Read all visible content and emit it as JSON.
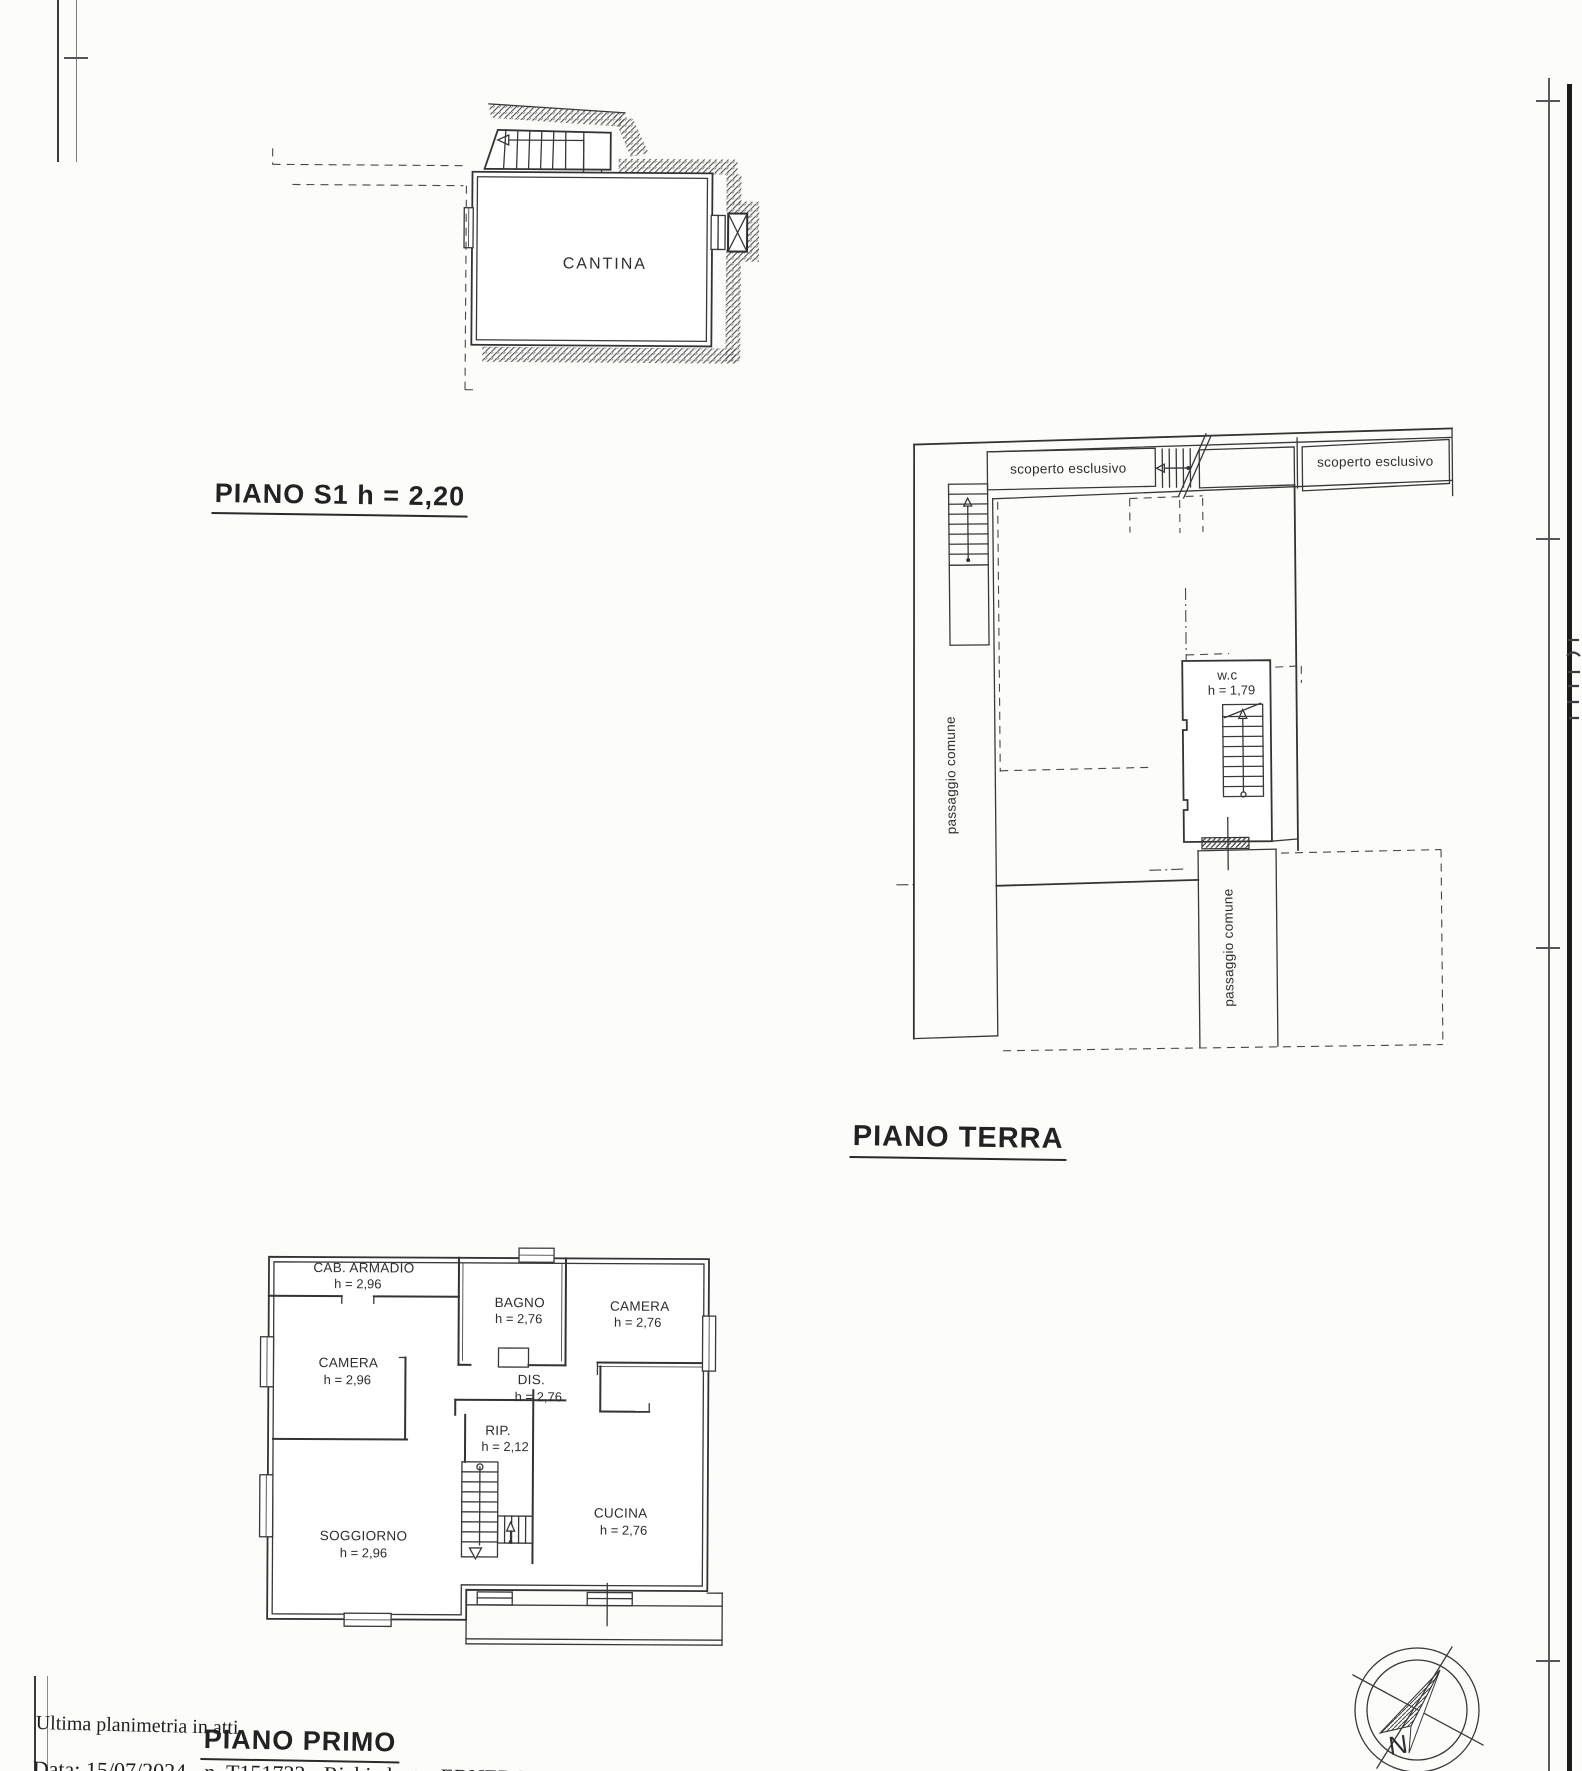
{
  "page": {
    "width": 1582,
    "height": 1771,
    "paper": "#fcfcfb",
    "ink": "#2e2e2e"
  },
  "plans": {
    "s1": {
      "title": "PIANO S1 h = 2,20",
      "room_label": "CANTINA"
    },
    "terra": {
      "title": "PIANO TERRA",
      "labels": {
        "scoperto_left": "scoperto esclusivo",
        "scoperto_right": "scoperto esclusivo",
        "passaggio_left": "passaggio comune",
        "passaggio_bottom": "passaggio comune",
        "wc_name": "w.c",
        "wc_height": "h = 1,79"
      }
    },
    "primo": {
      "title": "PIANO PRIMO",
      "rooms": [
        {
          "name": "CAB. ARMADIO",
          "height": "h = 2,96"
        },
        {
          "name": "BAGNO",
          "height": "h = 2,76"
        },
        {
          "name": "CAMERA",
          "height": "h = 2,76"
        },
        {
          "name": "CAMERA",
          "height": "h = 2,96"
        },
        {
          "name": "DIS.",
          "height": "h = 2,76"
        },
        {
          "name": "RIP.",
          "height": "h = 2,12"
        },
        {
          "name": "SOGGIORNO",
          "height": "h = 2,96"
        },
        {
          "name": "CUCINA",
          "height": "h = 2,76"
        }
      ]
    }
  },
  "footer": {
    "note": "Ultima planimetria in atti",
    "record_line": "Data: 15/07/2024 - n. T151733 - Richiedente: ERNERC62B18A4"
  },
  "compass": {
    "north_label": "N"
  }
}
